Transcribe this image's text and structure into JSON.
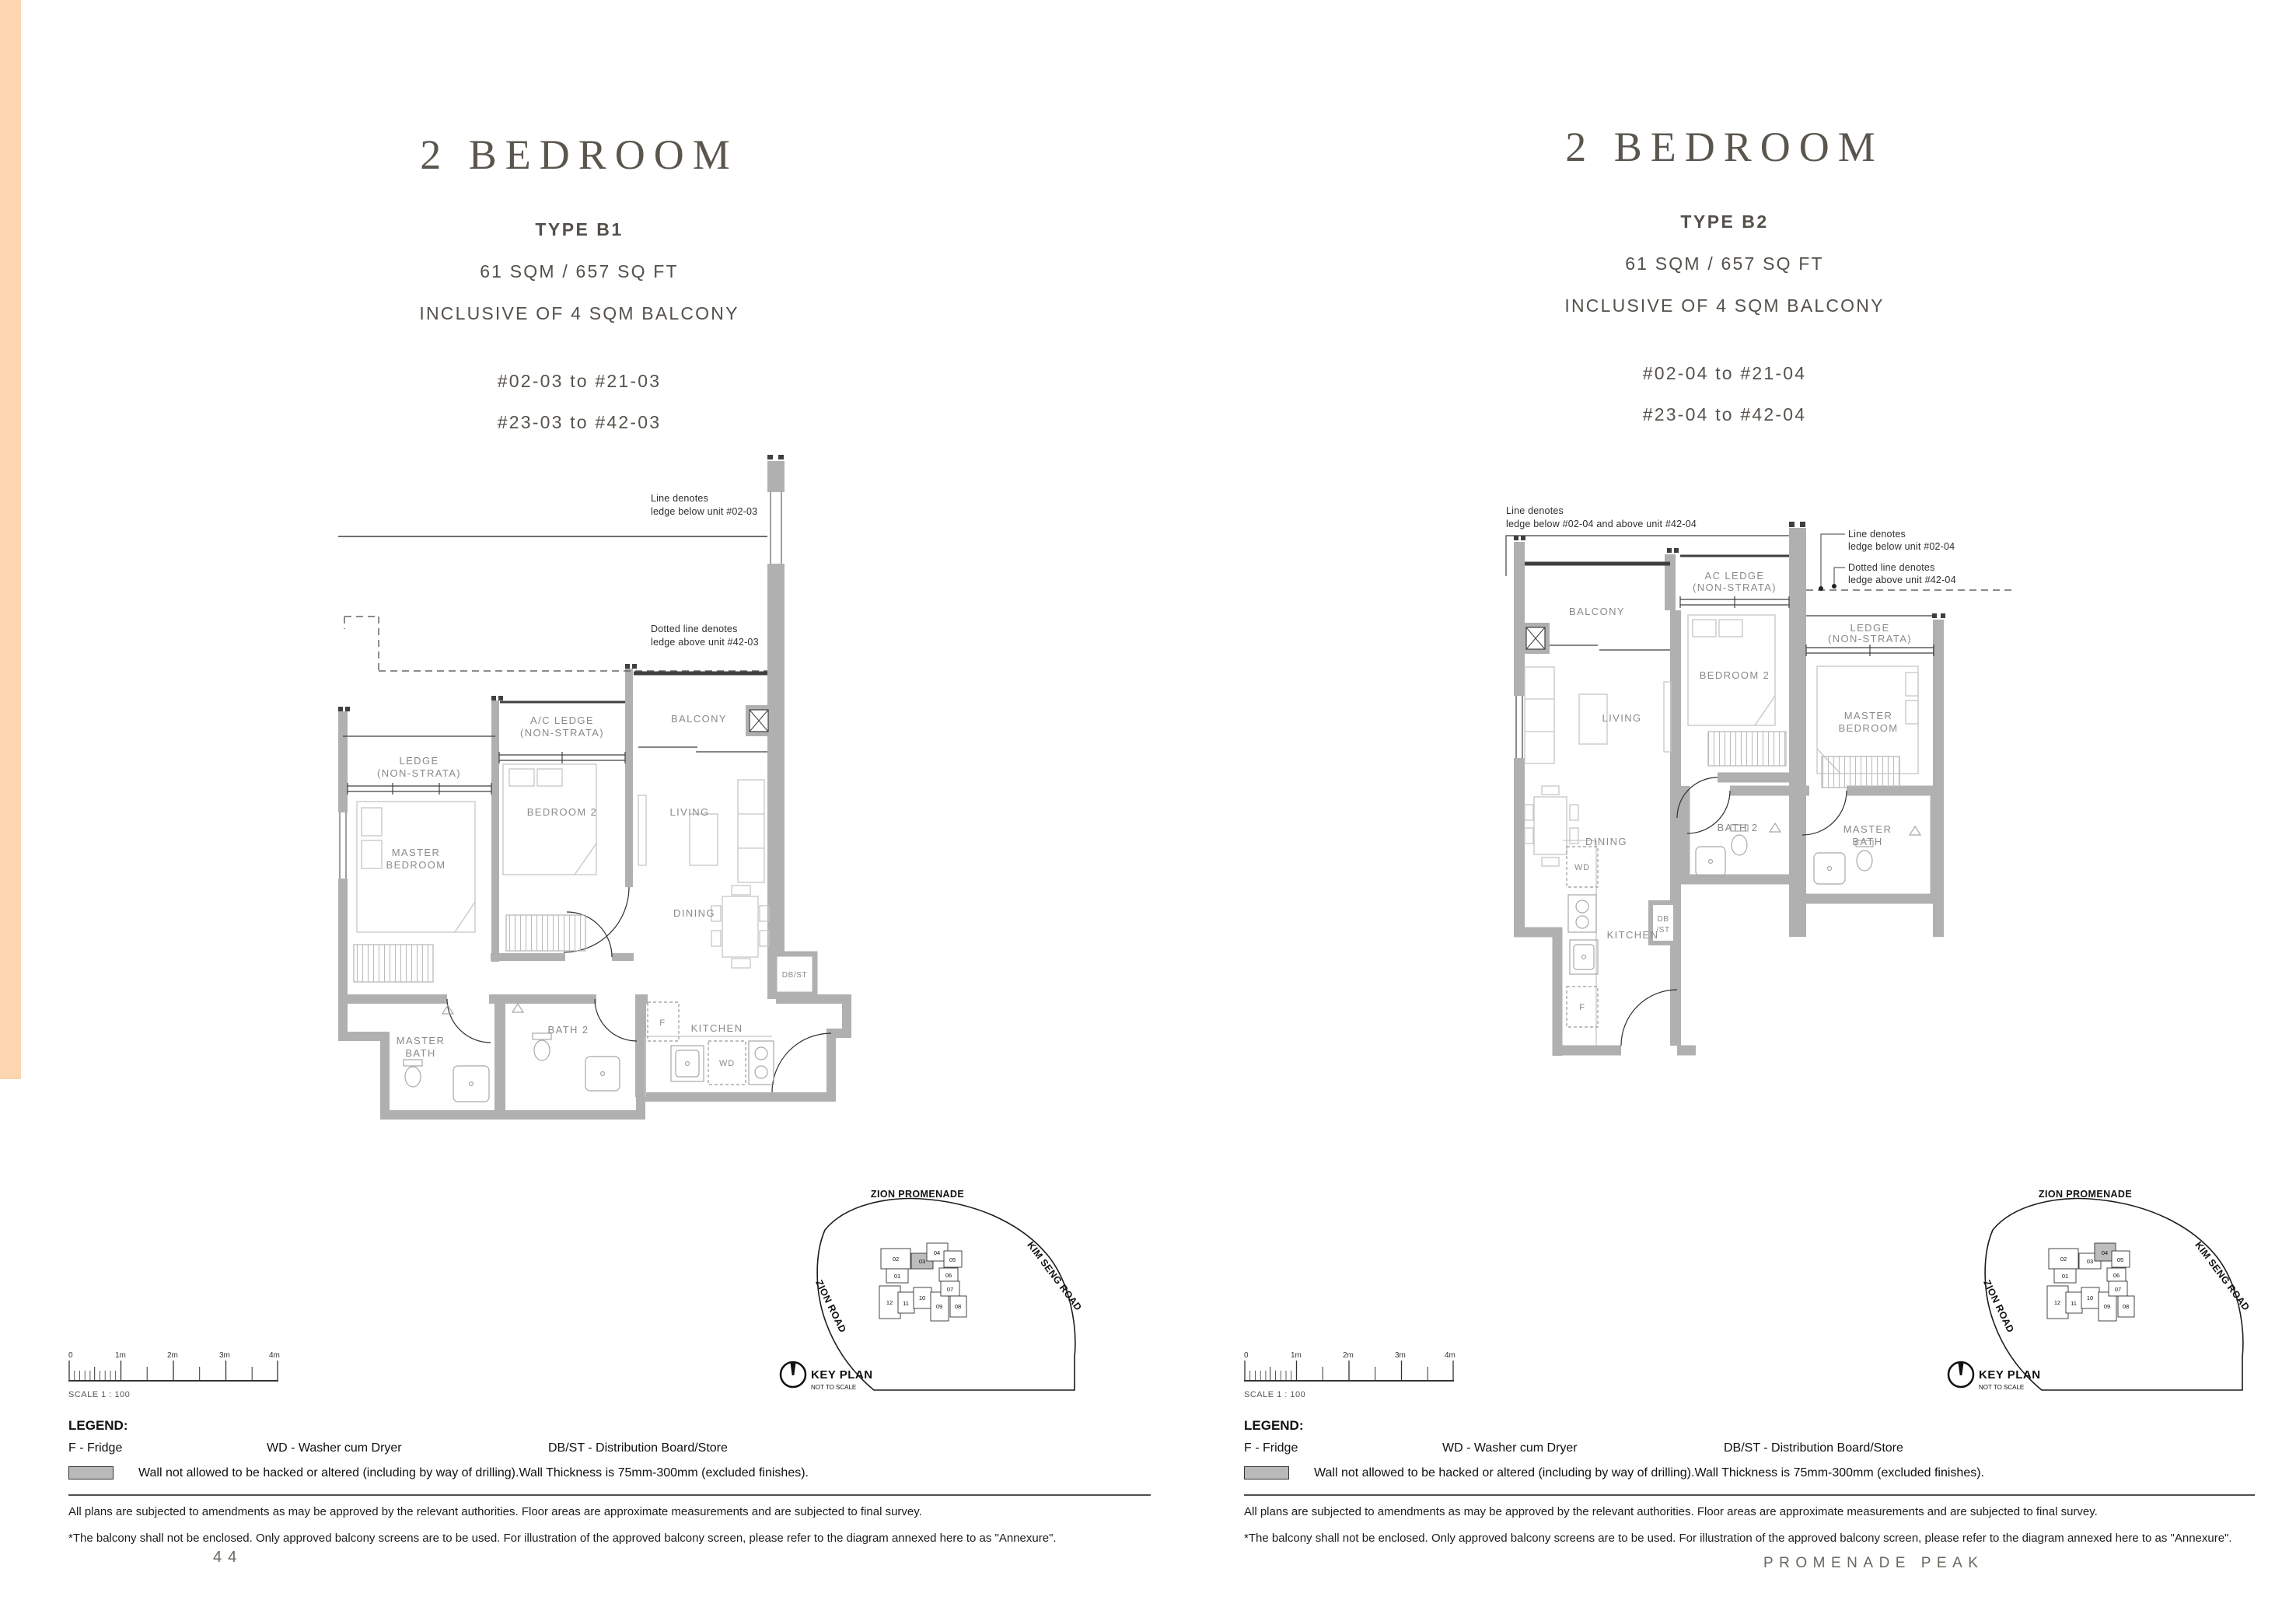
{
  "page": {
    "accent_color": "#fbd6b1",
    "page_number": "44",
    "brand": "PROMENADE PEAK"
  },
  "b1": {
    "title": "2 BEDROOM",
    "type": "TYPE B1",
    "area": "61 SQM / 657 SQ FT",
    "inclusive": "INCLUSIVE OF 4 SQM BALCONY",
    "units1": "#02-03 to #21-03",
    "units2": "#23-03 to #42-03",
    "ann": {
      "solid1": "Line denotes",
      "solid2": "ledge below unit #02-03",
      "dash1": "Dotted line denotes",
      "dash2": "ledge above unit #42-03"
    },
    "rooms": {
      "ledge1": "LEDGE",
      "ledge2": "(NON-STRATA)",
      "ac1": "A/C LEDGE",
      "ac2": "(NON-STRATA)",
      "balcony": "BALCONY",
      "bedroom2": "BEDROOM 2",
      "living": "LIVING",
      "master1": "MASTER",
      "master2": "BEDROOM",
      "dining": "DINING",
      "dbst": "DB/ST",
      "mbath1": "MASTER",
      "mbath2": "BATH",
      "bath2": "BATH 2",
      "f": "F",
      "kitchen": "KITCHEN",
      "wd": "WD"
    }
  },
  "b2": {
    "title": "2 BEDROOM",
    "type": "TYPE B2",
    "area": "61 SQM / 657 SQ FT",
    "inclusive": "INCLUSIVE OF 4 SQM BALCONY",
    "units1": "#02-04 to #21-04",
    "units2": "#23-04 to #42-04",
    "ann": {
      "top1": "Line denotes",
      "top2": "ledge below #02-04 and above unit #42-04",
      "solid1": "Line denotes",
      "solid2": "ledge below unit #02-04",
      "dash1": "Dotted line denotes",
      "dash2": "ledge above unit #42-04"
    },
    "rooms": {
      "balcony": "BALCONY",
      "ac1": "AC LEDGE",
      "ac2": "(NON-STRATA)",
      "ledge1": "LEDGE",
      "ledge2": "(NON-STRATA)",
      "bedroom2": "BEDROOM 2",
      "living": "LIVING",
      "master1": "MASTER",
      "master2": "BEDROOM",
      "dining": "DINING",
      "kitchen": "KITCHEN",
      "wd": "WD",
      "f": "F",
      "dbst1": "DB",
      "dbst2": "/ST",
      "bath2": "BATH 2",
      "mbath1": "MASTER",
      "mbath2": "BATH"
    }
  },
  "keyplan": {
    "title": "KEY PLAN",
    "nts": "NOT TO SCALE",
    "road_top": "ZION PROMENADE",
    "road_right": "KIM SENG ROAD",
    "road_left": "ZION ROAD",
    "blocks": {
      "b01": "01",
      "b02": "02",
      "b03": "03",
      "b04": "04",
      "b05": "05",
      "b06": "06",
      "b07": "07",
      "b08": "08",
      "b09": "09",
      "b10": "10",
      "b11": "11",
      "b12": "12"
    }
  },
  "scalebar": {
    "t0": "0",
    "t1": "1m",
    "t2": "2m",
    "t3": "3m",
    "t4": "4m",
    "label": "SCALE 1 : 100"
  },
  "legend": {
    "title": "LEGEND:",
    "f": "F - Fridge",
    "wd": "WD - Washer cum Dryer",
    "dbst": "DB/ST - Distribution Board/Store",
    "wall_note": "Wall not allowed to be hacked or altered (including by way of drilling).Wall Thickness is 75mm-300mm (excluded finishes)."
  },
  "disclaimer": {
    "l1": "All plans are subjected to amendments as may be approved by the relevant authorities. Floor areas are approximate measurements and are subjected to final survey.",
    "l2": "*The balcony shall not be enclosed. Only approved balcony screens are to be used. For illustration of the approved balcony screen, please refer to the diagram annexed here to as \"Annexure\"."
  }
}
